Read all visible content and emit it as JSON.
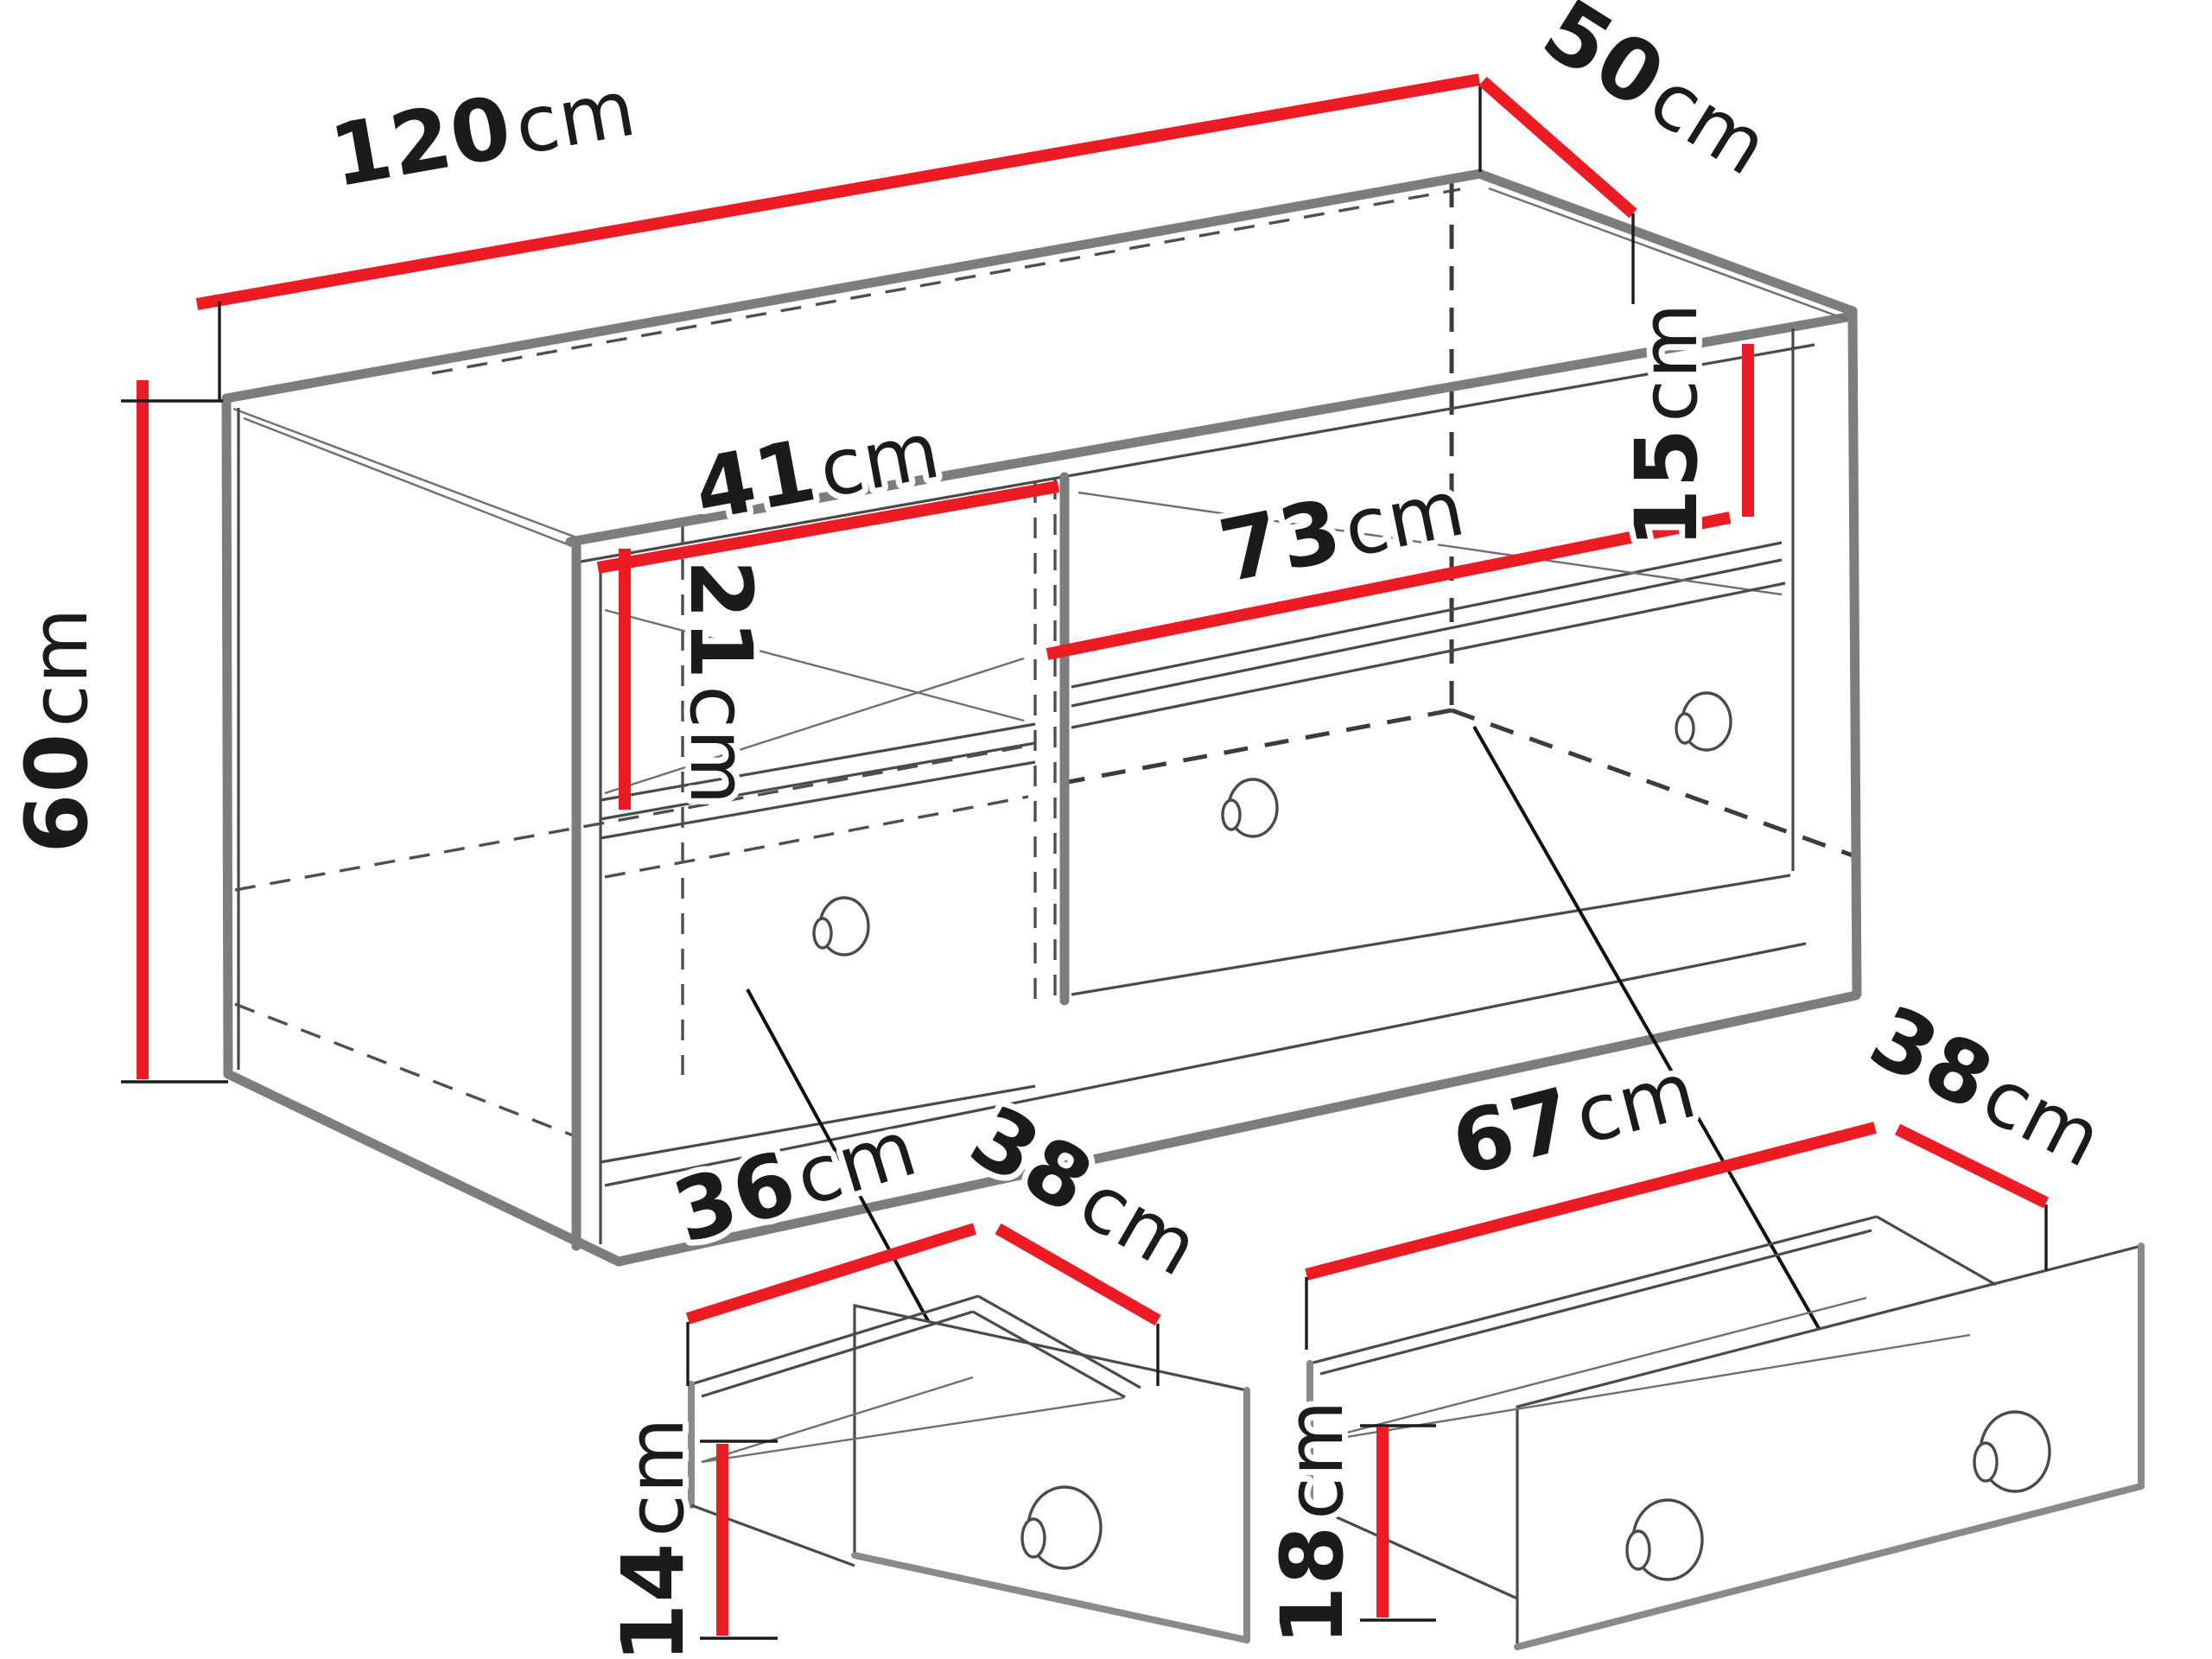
{
  "title": "TV cabinet dimension diagram",
  "colors": {
    "dimension_line": "#ED1C24",
    "outline": "#4a4a4a",
    "shadow_edge": "#7d7d7d",
    "background": "#ffffff",
    "text": "#1b1b1b"
  },
  "cabinet": {
    "width": {
      "value": "120",
      "unit": "cm"
    },
    "depth": {
      "value": "50",
      "unit": "cm"
    },
    "height": {
      "value": "60",
      "unit": "cm"
    },
    "left_niche_width": {
      "value": "41",
      "unit": "cm"
    },
    "left_niche_height": {
      "value": "21",
      "unit": "cm"
    },
    "right_niche_width": {
      "value": "73",
      "unit": "cm"
    },
    "right_niche_height": {
      "value": "15",
      "unit": "cm"
    }
  },
  "small_drawer": {
    "width": {
      "value": "36",
      "unit": "cm"
    },
    "depth": {
      "value": "38",
      "unit": "cm"
    },
    "height": {
      "value": "14",
      "unit": "cm"
    }
  },
  "large_drawer": {
    "width": {
      "value": "67",
      "unit": "cm"
    },
    "depth": {
      "value": "38",
      "unit": "cm"
    },
    "height": {
      "value": "18",
      "unit": "cm"
    }
  }
}
